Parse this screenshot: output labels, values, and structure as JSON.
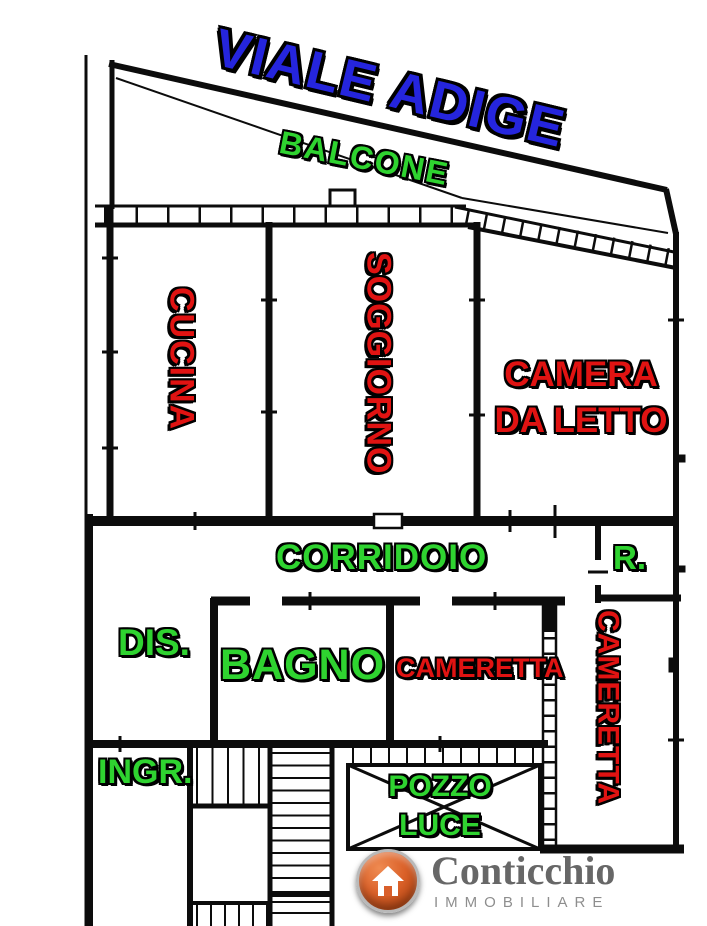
{
  "street": {
    "label": "VIALE ADIGE"
  },
  "rooms": {
    "balcone": "BALCONE",
    "cucina": "CUCINA",
    "soggiorno": "SOGGIORNO",
    "camera_da_letto": "CAMERA DA LETTO",
    "corridoio": "CORRIDOIO",
    "ripostiglio": "R.",
    "disimpegno": "DIS.",
    "bagno": "BAGNO",
    "cameretta_piccola": "CAMERETTA",
    "cameretta_grande": "CAMERETTA",
    "ingresso": "INGR.",
    "pozzo_luce": "POZZO LUCE"
  },
  "logo": {
    "name": "Conticchio",
    "tagline": "IMMOBILIARE",
    "icon": "house-icon"
  },
  "colors": {
    "street-blue": "#2525dd",
    "room-green": "#2fd330",
    "room-red": "#e01312",
    "wall-black": "#0c0c0c",
    "logo-orange": "#d95f2b",
    "logo-name-gray": "#676767",
    "logo-tagline-gray": "#8e8e8e"
  }
}
